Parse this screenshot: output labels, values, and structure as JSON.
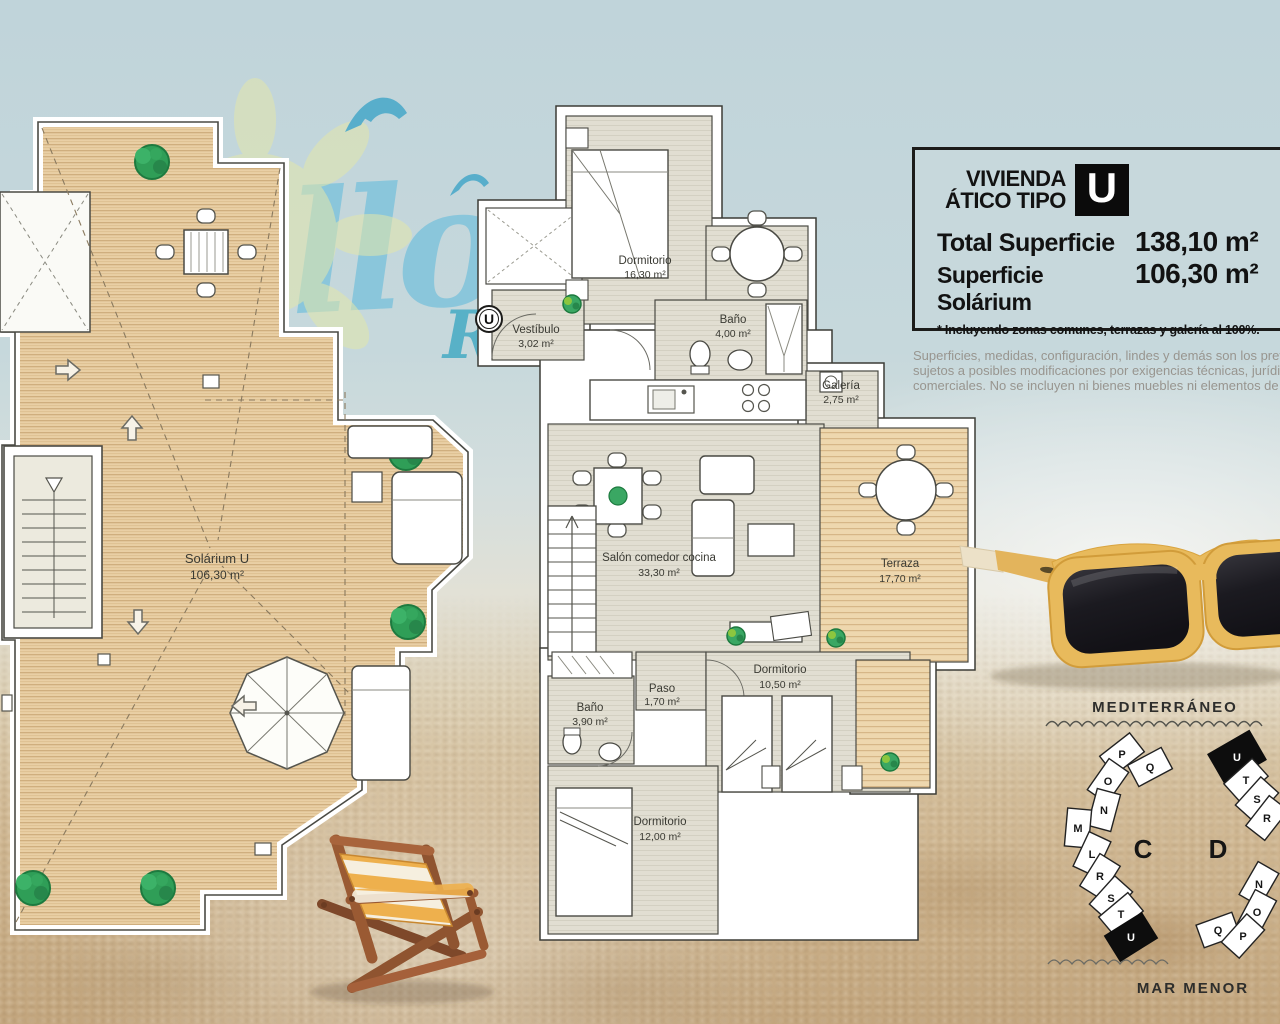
{
  "title_block": {
    "line1": "VIVIENDA",
    "line2": "ÁTICO TIPO",
    "type_letter": "U",
    "total_label": "Total Superficie",
    "total_value": "138,10 m²",
    "solarium_label": "Superficie Solárium",
    "solarium_value": "106,30 m²",
    "footnote": "* Incluyendo zonas comunes, terrazas y galería al 100%."
  },
  "disclaimer": {
    "line1": "Superficies, medidas, configuración, lindes y demás son los previsto",
    "line2": "sujetos a posibles modificaciones por exigencias técnicas, jurídicas o",
    "line3": "comerciales. No se incluyen ni bienes muebles ni elementos de jard"
  },
  "watermarks": {
    "script_fragment": "llo",
    "letter_fragment": "R"
  },
  "apartment": {
    "entrance_marker": "U",
    "rooms": [
      {
        "name": "Dormitorio",
        "area": "16,30 m²"
      },
      {
        "name": "Vestíbulo",
        "area": "3,02 m²"
      },
      {
        "name": "Baño",
        "area": "4,00 m²"
      },
      {
        "name": "Galería",
        "area": "2,75 m²"
      },
      {
        "name": "Salón comedor cocina",
        "area": "33,30 m²"
      },
      {
        "name": "Terraza",
        "area": "17,70 m²"
      },
      {
        "name": "Dormitorio",
        "area": "10,50 m²"
      },
      {
        "name": "Paso",
        "area": "1,70 m²"
      },
      {
        "name": "Baño",
        "area": "3,90 m²"
      },
      {
        "name": "Dormitorio",
        "area": "12,00 m²"
      }
    ]
  },
  "solarium": {
    "name": "Solárium U",
    "area": "106,30 m²"
  },
  "site_plan": {
    "sea_label": "MEDITERRÁNEO",
    "lagoon_label": "MAR MENOR",
    "blocks": [
      {
        "label": "C",
        "units": [
          "P",
          "Q",
          "O",
          "N",
          "M",
          "L",
          "R",
          "S",
          "T",
          "U"
        ],
        "highlighted": "U"
      },
      {
        "label": "D",
        "units": [
          "U",
          "T",
          "S",
          "R",
          "N",
          "O",
          "Q",
          "P"
        ],
        "highlighted": "U"
      }
    ]
  },
  "colors": {
    "wood_deck": "#e9cfa5",
    "room_fill": "#e1ded2",
    "sky": "#c3d6db",
    "sand": "#d2bb97",
    "sunglasses_frame": "#e8ba5c",
    "highlight_black": "#111111",
    "watermark_blue": "#7cc3da",
    "plant_green": "#2f9e57"
  }
}
